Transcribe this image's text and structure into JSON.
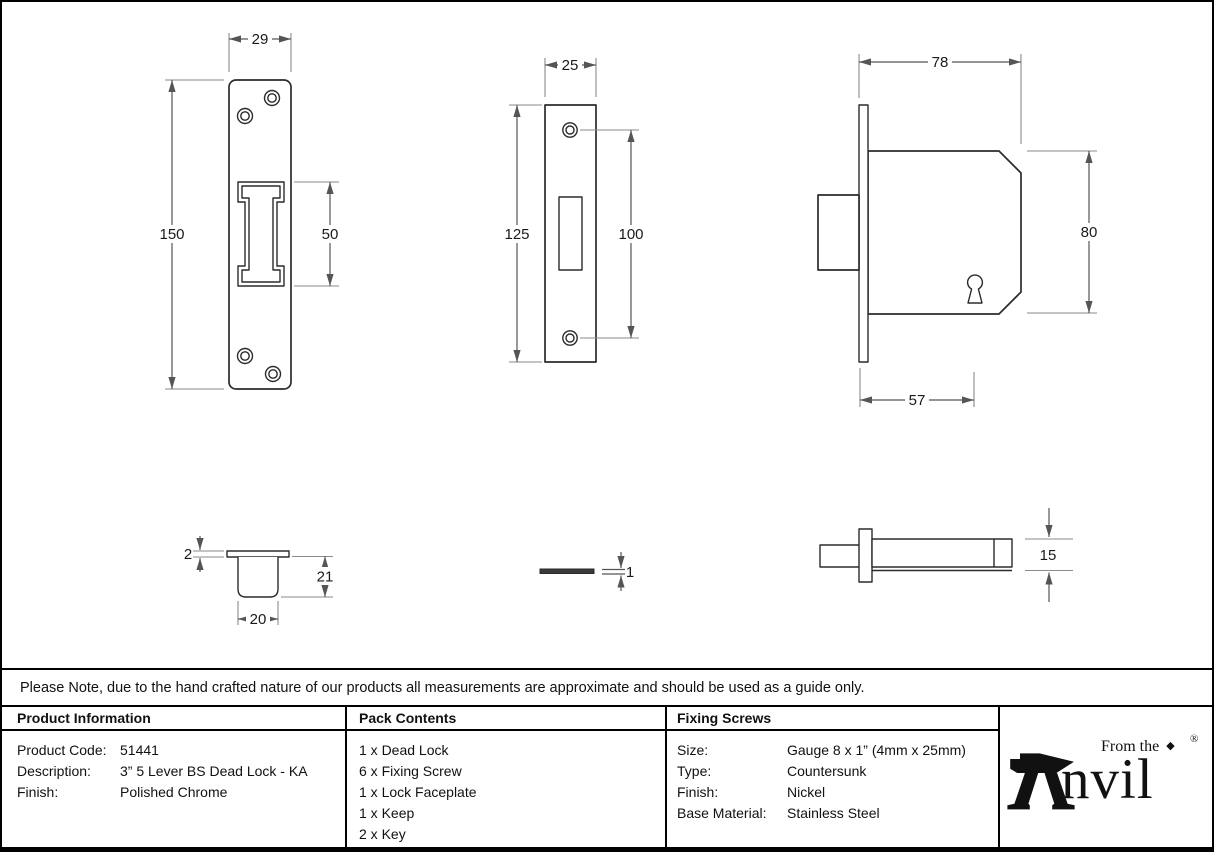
{
  "note": "Please Note, due to the hand crafted nature of our products all measurements are approximate and should be used as a guide only.",
  "drawings": {
    "keep_front": {
      "width": "29",
      "height": "150",
      "slot_height": "50"
    },
    "faceplate_front": {
      "width": "25",
      "height": "125",
      "hole_spacing": "100"
    },
    "lock_side": {
      "overall_width": "78",
      "case_height": "80",
      "case_depth": "57"
    },
    "keep_profile": {
      "flange_thickness": "2",
      "cup_depth": "21",
      "cup_width": "20"
    },
    "faceplate_profile": {
      "thickness": "1"
    },
    "lock_top": {
      "case_thickness": "15"
    }
  },
  "table": {
    "product_information": {
      "header": "Product Information",
      "rows": [
        {
          "label": "Product Code:",
          "value": "51441"
        },
        {
          "label": "Description:",
          "value": "3” 5 Lever BS Dead Lock - KA"
        },
        {
          "label": "Finish:",
          "value": "Polished Chrome"
        }
      ]
    },
    "pack_contents": {
      "header": "Pack Contents",
      "items": [
        "1 x Dead Lock",
        "6 x Fixing Screw",
        "1 x Lock Faceplate",
        "1 x Keep",
        "2 x Key"
      ]
    },
    "fixing_screws": {
      "header": "Fixing Screws",
      "rows": [
        {
          "label": "Size:",
          "value": "Gauge 8 x 1” (4mm x 25mm)"
        },
        {
          "label": "Type:",
          "value": "Countersunk"
        },
        {
          "label": "Finish:",
          "value": "Nickel"
        },
        {
          "label": "Base Material:",
          "value": "Stainless Steel"
        }
      ]
    }
  },
  "logo": {
    "tagline": "From the",
    "diamond": "◆",
    "name": "nvil",
    "registered": "®"
  },
  "colors": {
    "line": "#2b2b2b",
    "dimension": "#555555",
    "border": "#000000"
  }
}
